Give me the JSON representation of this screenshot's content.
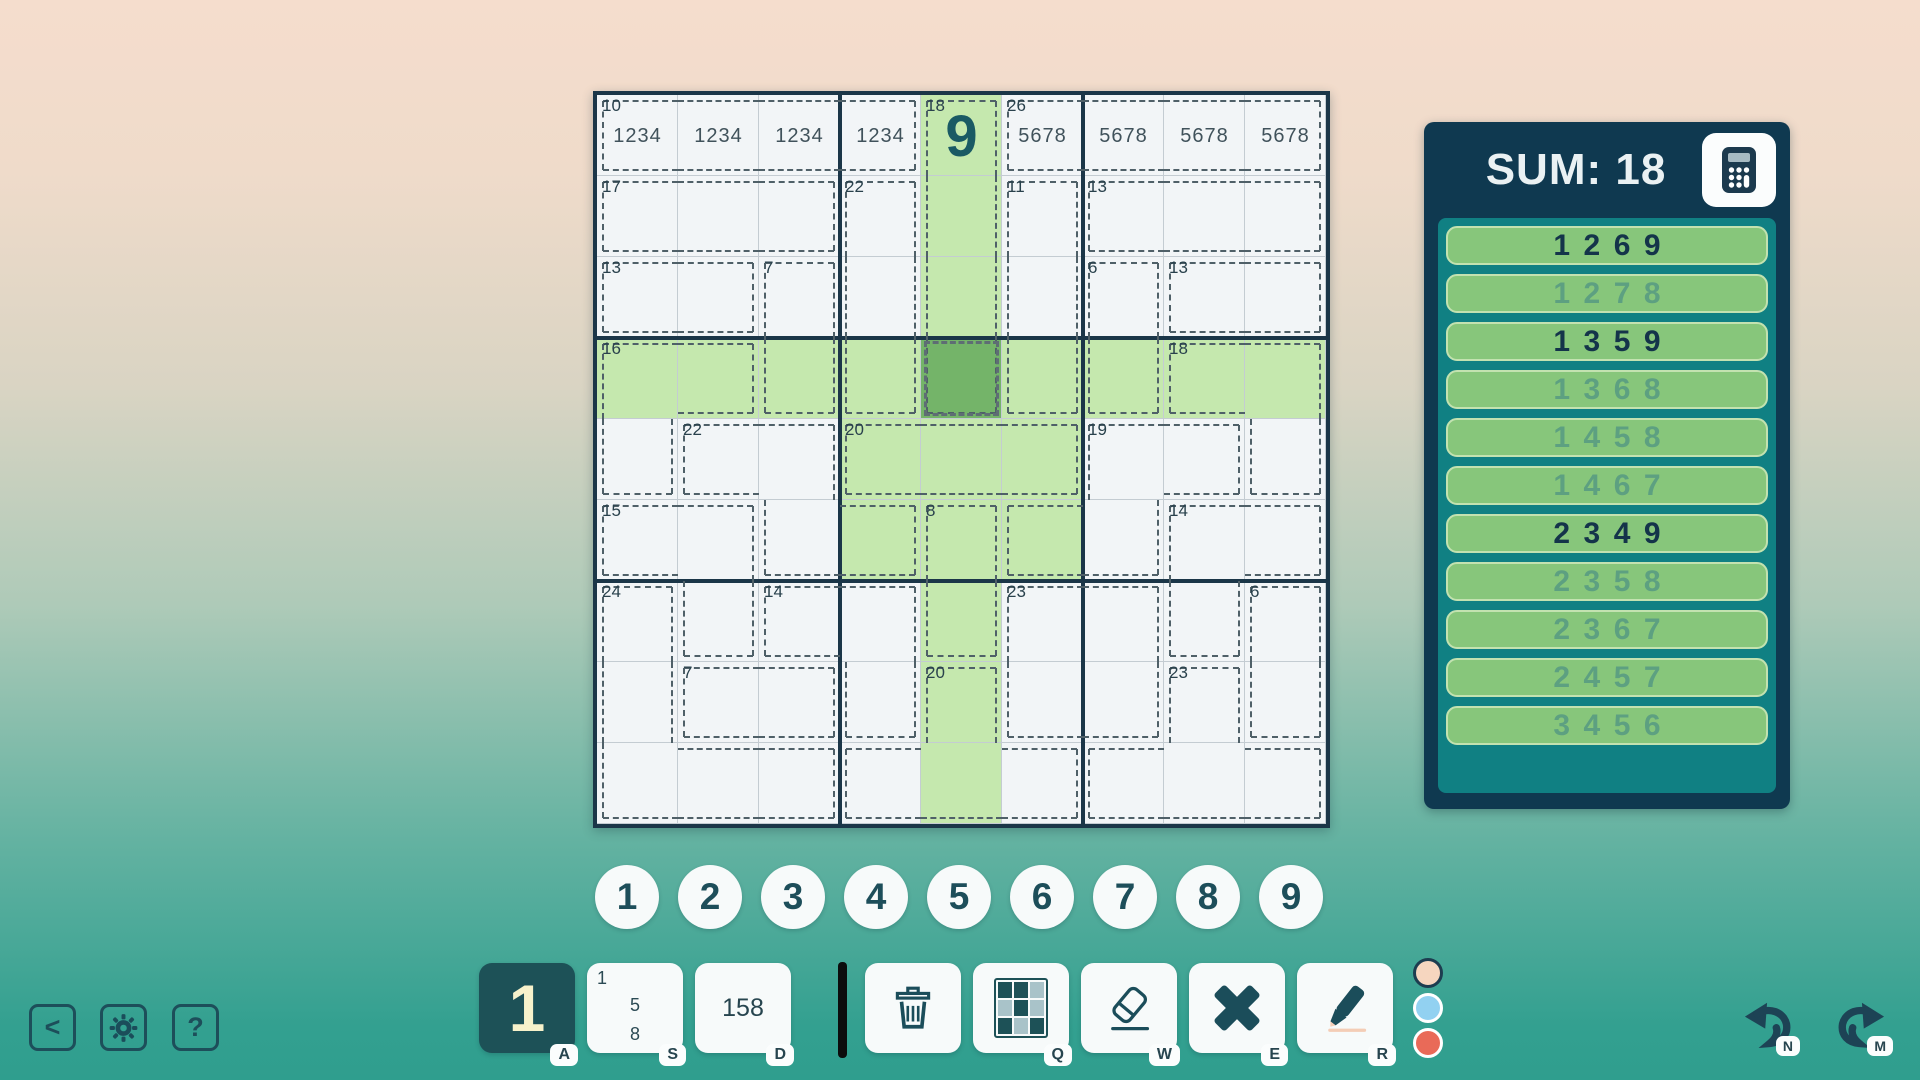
{
  "board": {
    "size": 9,
    "cages": [
      {
        "sum": "10",
        "cells": [
          [
            1,
            1
          ],
          [
            1,
            2
          ],
          [
            1,
            3
          ],
          [
            1,
            4
          ]
        ]
      },
      {
        "sum": "18",
        "cells": [
          [
            1,
            5
          ],
          [
            2,
            5
          ],
          [
            3,
            5
          ],
          [
            4,
            5
          ]
        ]
      },
      {
        "sum": "26",
        "cells": [
          [
            1,
            6
          ],
          [
            1,
            7
          ],
          [
            1,
            8
          ],
          [
            1,
            9
          ]
        ]
      },
      {
        "sum": "17",
        "cells": [
          [
            2,
            1
          ],
          [
            2,
            2
          ],
          [
            2,
            3
          ]
        ]
      },
      {
        "sum": "22",
        "cells": [
          [
            2,
            4
          ],
          [
            3,
            4
          ],
          [
            4,
            4
          ]
        ]
      },
      {
        "sum": "11",
        "cells": [
          [
            2,
            6
          ],
          [
            3,
            6
          ],
          [
            4,
            6
          ]
        ]
      },
      {
        "sum": "13",
        "cells": [
          [
            2,
            7
          ],
          [
            2,
            8
          ],
          [
            2,
            9
          ]
        ]
      },
      {
        "sum": "13",
        "cells": [
          [
            3,
            1
          ],
          [
            3,
            2
          ]
        ]
      },
      {
        "sum": "7",
        "cells": [
          [
            3,
            3
          ],
          [
            4,
            3
          ]
        ]
      },
      {
        "sum": "6",
        "cells": [
          [
            3,
            7
          ],
          [
            4,
            7
          ]
        ]
      },
      {
        "sum": "13",
        "cells": [
          [
            3,
            8
          ],
          [
            3,
            9
          ]
        ]
      },
      {
        "sum": "16",
        "cells": [
          [
            4,
            1
          ],
          [
            4,
            2
          ],
          [
            5,
            1
          ]
        ]
      },
      {
        "sum": "18",
        "cells": [
          [
            4,
            8
          ],
          [
            4,
            9
          ],
          [
            5,
            9
          ]
        ]
      },
      {
        "sum": "22",
        "cells": [
          [
            5,
            2
          ],
          [
            5,
            3
          ],
          [
            6,
            3
          ],
          [
            6,
            4
          ]
        ]
      },
      {
        "sum": "20",
        "cells": [
          [
            5,
            4
          ],
          [
            5,
            5
          ],
          [
            5,
            6
          ]
        ]
      },
      {
        "sum": "19",
        "cells": [
          [
            5,
            7
          ],
          [
            5,
            8
          ],
          [
            6,
            6
          ],
          [
            6,
            7
          ]
        ]
      },
      {
        "sum": "15",
        "cells": [
          [
            6,
            1
          ],
          [
            6,
            2
          ],
          [
            7,
            2
          ]
        ]
      },
      {
        "sum": "8",
        "cells": [
          [
            6,
            5
          ],
          [
            7,
            5
          ]
        ]
      },
      {
        "sum": "14",
        "cells": [
          [
            6,
            8
          ],
          [
            6,
            9
          ],
          [
            7,
            8
          ]
        ]
      },
      {
        "sum": "24",
        "cells": [
          [
            7,
            1
          ],
          [
            8,
            1
          ],
          [
            9,
            1
          ],
          [
            9,
            2
          ],
          [
            9,
            3
          ]
        ]
      },
      {
        "sum": "14",
        "cells": [
          [
            7,
            3
          ],
          [
            7,
            4
          ],
          [
            8,
            4
          ]
        ]
      },
      {
        "sum": "23",
        "cells": [
          [
            7,
            6
          ],
          [
            7,
            7
          ],
          [
            8,
            6
          ],
          [
            8,
            7
          ]
        ]
      },
      {
        "sum": "6",
        "cells": [
          [
            7,
            9
          ],
          [
            8,
            9
          ]
        ]
      },
      {
        "sum": "7",
        "cells": [
          [
            8,
            2
          ],
          [
            8,
            3
          ]
        ]
      },
      {
        "sum": "20",
        "cells": [
          [
            8,
            5
          ],
          [
            9,
            4
          ],
          [
            9,
            5
          ],
          [
            9,
            6
          ]
        ]
      },
      {
        "sum": "23",
        "cells": [
          [
            8,
            8
          ],
          [
            9,
            7
          ],
          [
            9,
            8
          ],
          [
            9,
            9
          ]
        ]
      }
    ],
    "values": [
      {
        "r": 1,
        "c": 5,
        "text": "9"
      }
    ],
    "center_marks": [
      {
        "r": 1,
        "c": 1,
        "text": "1234"
      },
      {
        "r": 1,
        "c": 2,
        "text": "1234"
      },
      {
        "r": 1,
        "c": 3,
        "text": "1234"
      },
      {
        "r": 1,
        "c": 4,
        "text": "1234"
      },
      {
        "r": 1,
        "c": 6,
        "text": "5678"
      },
      {
        "r": 1,
        "c": 7,
        "text": "5678"
      },
      {
        "r": 1,
        "c": 8,
        "text": "5678"
      },
      {
        "r": 1,
        "c": 9,
        "text": "5678"
      }
    ],
    "highlight": {
      "row": 4,
      "col": 5,
      "box_row_start": 4,
      "box_col_start": 4,
      "selected_r": 4,
      "selected_c": 5
    },
    "colors": {
      "highlight_green": "#c5e8ae",
      "selected_green": "#74b469",
      "cell_bg": "#f2f5f7",
      "given_digit": "#1a5a64"
    }
  },
  "sum_panel": {
    "title": "SUM: 18",
    "combos": [
      {
        "digits": "1269",
        "active": true
      },
      {
        "digits": "1278",
        "active": false
      },
      {
        "digits": "1359",
        "active": true
      },
      {
        "digits": "1368",
        "active": false
      },
      {
        "digits": "1458",
        "active": false
      },
      {
        "digits": "1467",
        "active": false
      },
      {
        "digits": "2349",
        "active": true
      },
      {
        "digits": "2358",
        "active": false
      },
      {
        "digits": "2367",
        "active": false
      },
      {
        "digits": "2457",
        "active": false
      },
      {
        "digits": "3456",
        "active": false
      }
    ],
    "colors": {
      "panel_bg": "#0f3950",
      "inner_bg": "#108083",
      "pill_bg": "#87c67b",
      "active_text": "#14344a",
      "muted_text": "#5da081"
    }
  },
  "number_pad": {
    "digits": [
      "1",
      "2",
      "3",
      "4",
      "5",
      "6",
      "7",
      "8",
      "9"
    ]
  },
  "mode_bar": {
    "normal": {
      "label": "1",
      "shortcut": "A",
      "active": true
    },
    "corner": {
      "marks": [
        "1",
        "5",
        "8"
      ],
      "shortcut": "S"
    },
    "center": {
      "label": "158",
      "shortcut": "D"
    }
  },
  "tools": {
    "items": [
      {
        "name": "delete"
      },
      {
        "name": "color-palette",
        "shortcut": "Q"
      },
      {
        "name": "eraser",
        "shortcut": "W"
      },
      {
        "name": "clear-cross",
        "shortcut": "E"
      },
      {
        "name": "pen",
        "shortcut": "R"
      }
    ]
  },
  "palette_dots": {
    "dots": [
      {
        "color": "#f6d6bf",
        "ring": "#1d3d50"
      },
      {
        "color": "#92d1f1",
        "ring": "#ffffff"
      },
      {
        "color": "#e96a58",
        "ring": "#ffffff"
      }
    ]
  },
  "nav": {
    "back_label": "<",
    "help_label": "?"
  },
  "history": {
    "undo_shortcut": "N",
    "redo_shortcut": "M"
  }
}
